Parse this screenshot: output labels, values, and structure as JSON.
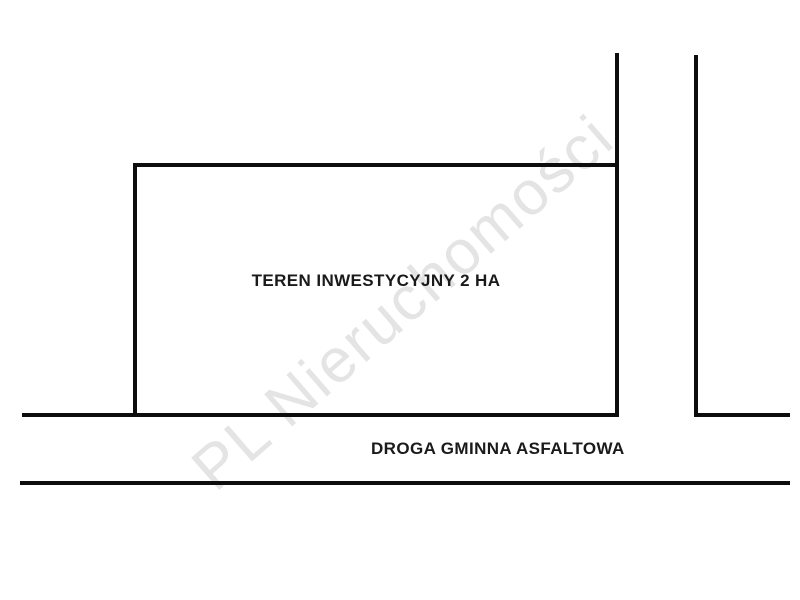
{
  "diagram": {
    "type": "land-plot-sketch",
    "plot": {
      "label": "TEREN INWESTYCYJNY 2 HA"
    },
    "road": {
      "label": "DROGA GMINNA ASFALTOWA"
    },
    "watermark": {
      "text": "PL Nieruchomości"
    },
    "colors": {
      "background": "#ffffff",
      "line": "#0d0d0d",
      "label_text": "#1a1a1a",
      "watermark": "#e4e4e4"
    }
  }
}
